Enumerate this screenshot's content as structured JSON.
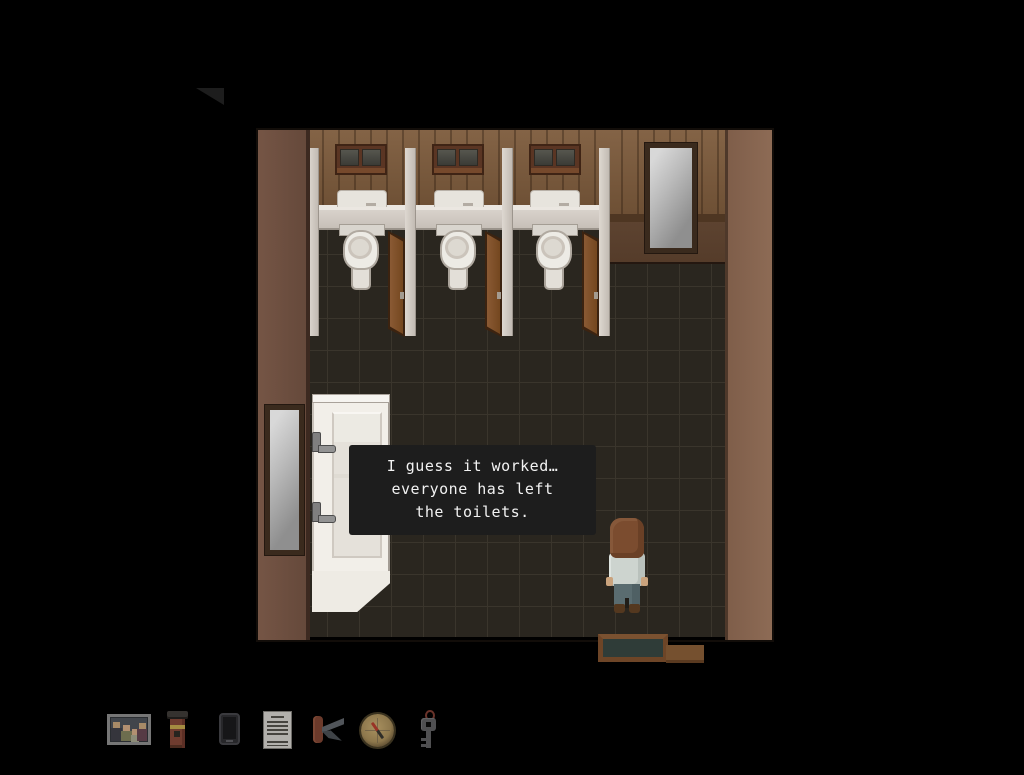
{
  "dialog": {
    "lines": [
      "I guess it worked…",
      "everyone has left",
      "the toilets."
    ]
  },
  "inventory": {
    "items": [
      {
        "name": "family-photo"
      },
      {
        "name": "flashlight"
      },
      {
        "name": "smartphone"
      },
      {
        "name": "note"
      },
      {
        "name": "pocket-knife"
      },
      {
        "name": "compass"
      },
      {
        "name": "key"
      }
    ]
  },
  "scene": {
    "room": "public-toilets",
    "objects": [
      "toilet-stall-1",
      "toilet-stall-2",
      "toilet-stall-3",
      "wall-mirror-right",
      "wall-mirror-left",
      "sink",
      "player-character",
      "doormat"
    ]
  },
  "colors": {
    "background": "#000000",
    "bubble_bg": "#1d1d1d",
    "bubble_text": "#f2f2f2",
    "wall_wood": "#7d5b3c",
    "wall_left": "#6d4e3e",
    "wall_right": "#886651",
    "floor_tile": "#2a261f",
    "floor_grout": "#3a352c",
    "stall_partition": "#cdc6bf",
    "door_wood": "#7a4e2d",
    "porcelain": "#eceae4"
  }
}
